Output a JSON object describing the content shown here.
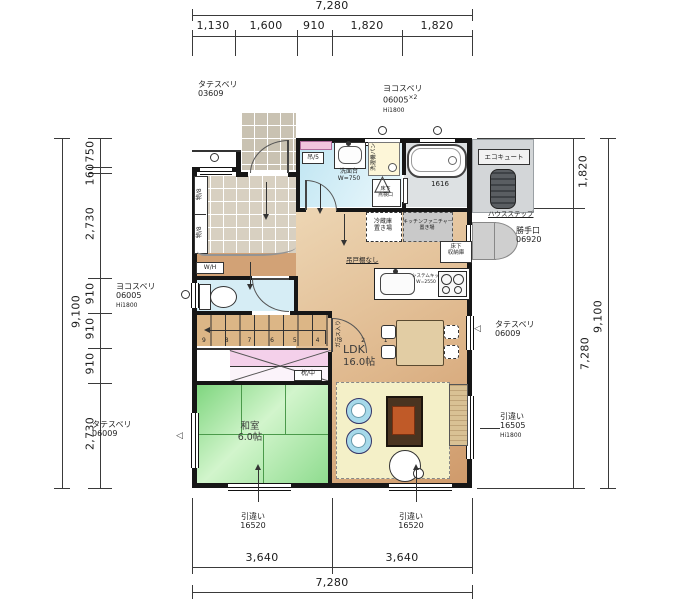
{
  "dims": {
    "top": {
      "total": "7,280",
      "segs": [
        "1,130",
        "1,600",
        "910",
        "1,820",
        "1,820"
      ]
    },
    "left": {
      "total": "9,100",
      "segs": [
        "750",
        "160",
        "2,730",
        "910",
        "910",
        "910",
        "2,730"
      ]
    },
    "right": {
      "total": "9,100",
      "segs": [
        "1,820",
        "7,280"
      ]
    },
    "bottom": {
      "total": "7,280",
      "segs": [
        "3,640",
        "3,640"
      ]
    }
  },
  "openings": {
    "top_left_window": [
      "タテスベリ",
      "03609"
    ],
    "top_right_window": [
      "ヨコスベリ",
      "06005",
      "×2",
      "Hi1800"
    ],
    "left_toilet_window": [
      "ヨコスベリ",
      "06005",
      "Hi1800"
    ],
    "left_washitsu_window": [
      "タテスベリ",
      "06009"
    ],
    "right_ldk_window": [
      "タテスベリ",
      "06009"
    ],
    "right_ldk_slider": [
      "引違い",
      "16505",
      "Hi1800"
    ],
    "bottom_washitsu_slider": [
      "引違い",
      "16520"
    ],
    "bottom_ldk_slider": [
      "引違い",
      "16520"
    ],
    "back_door": [
      "勝手口",
      "06920"
    ]
  },
  "rooms": {
    "ldk": [
      "LDK",
      "16.0帖"
    ],
    "washitsu": [
      "和室",
      "6.0帖"
    ]
  },
  "kitchen": {
    "fridge": [
      "冷蔵庫",
      "置き場"
    ],
    "furniture": [
      "キッチンファニチャー",
      "置き場"
    ],
    "floor_storage": [
      "床下",
      "収納庫"
    ],
    "no_hanging": "吊戸棚なし",
    "system": [
      "システムキッチン",
      "W=2550"
    ]
  },
  "sanitary": {
    "vanity": [
      "洗面台",
      "W=750"
    ],
    "washer": "洗濯機パン",
    "hatch": [
      "床下",
      "点検口"
    ],
    "shelf": "吊/5",
    "bath_size": "1616"
  },
  "entrance": {
    "shoe1": "物/8",
    "shoe2": "物/8",
    "wh": "W/H"
  },
  "misc": {
    "ecocute": "エコキュート",
    "housestep": "ハウスステップ",
    "closet": "枕/中",
    "glass": "ガラス入り",
    "stair_numbers": "9 8 7 6 5 4 3 2 1"
  },
  "colors": {
    "wall": "#161616",
    "tatami": "#8edc8e",
    "wood": "#dfb88d",
    "tile": "#d8d0c1",
    "water": "#bfe5f2",
    "rug": "#f4f0c8",
    "closet_pink": "#f4d0ea",
    "equipment": "#d3d6d8"
  }
}
